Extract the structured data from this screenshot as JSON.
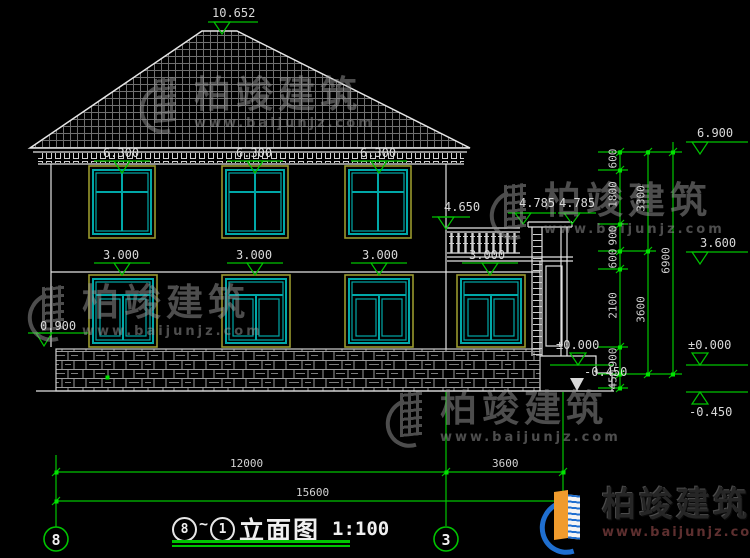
{
  "brand": {
    "name": "柏竣建筑",
    "site": "www.baijunjz.com"
  },
  "title": {
    "axis_from": "8",
    "axis_range_tilde": "~",
    "axis_to": "1",
    "name": "立面图",
    "scale": "1:100"
  },
  "axis_bubbles": {
    "left": "8",
    "right": "3"
  },
  "elevations": {
    "ridge": "10.652",
    "eave": "6.900",
    "floor2_window_top": "6.300",
    "balcony_rail": "4.650",
    "porch_canopy_left": "4.785",
    "porch_canopy_right": "4.785",
    "floor2_level": "3.600",
    "floor1_window_top": "3.000",
    "floor1_sill": "0.900",
    "ground_zero": "±0.000",
    "site_grade": "-0.450"
  },
  "dimensions": {
    "right_chain_inner": [
      "600",
      "1800",
      "900",
      "600",
      "2100",
      "900",
      "450"
    ],
    "right_chain_middle": [
      "3300",
      "3600"
    ],
    "right_chain_overall": "6900",
    "bottom_left": "12000",
    "bottom_right": "3600",
    "bottom_overall": "15600"
  },
  "colors": {
    "dim_green": "#00c400",
    "line_white": "#e2e2e2",
    "window_teal": "#00a8a8",
    "frame_yellow": "#99992e",
    "watermark_gray": "#9a9a9a",
    "logo_blue": "#1f6fd0",
    "logo_orange": "#f09b2d"
  }
}
